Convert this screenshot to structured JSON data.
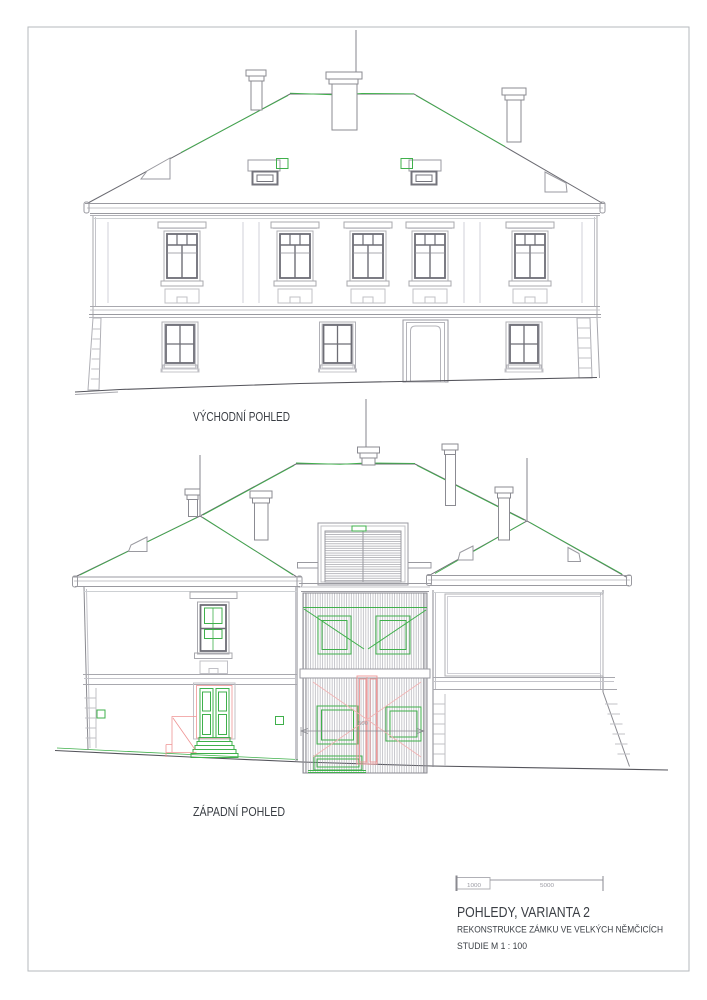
{
  "labels": {
    "east": "VÝCHODNÍ POHLED",
    "west": "ZÁPADNÍ POHLED"
  },
  "title_block": {
    "title": "POHLEDY, VARIANTA 2",
    "project": "REKONSTRUKCE ZÁMKU VE VELKÝCH NĚMČICÍCH",
    "study": "STUDIE M 1 : 100"
  },
  "scale_bar": {
    "seg1": "1000",
    "seg2": "5000"
  },
  "dimensions": {
    "center_width": "500"
  },
  "colors": {
    "accent_green": "#3fb04b",
    "accent_red": "#ef9494",
    "line_light": "#a8a8ae",
    "line_dark": "#55555c",
    "text": "#3a3e44"
  }
}
